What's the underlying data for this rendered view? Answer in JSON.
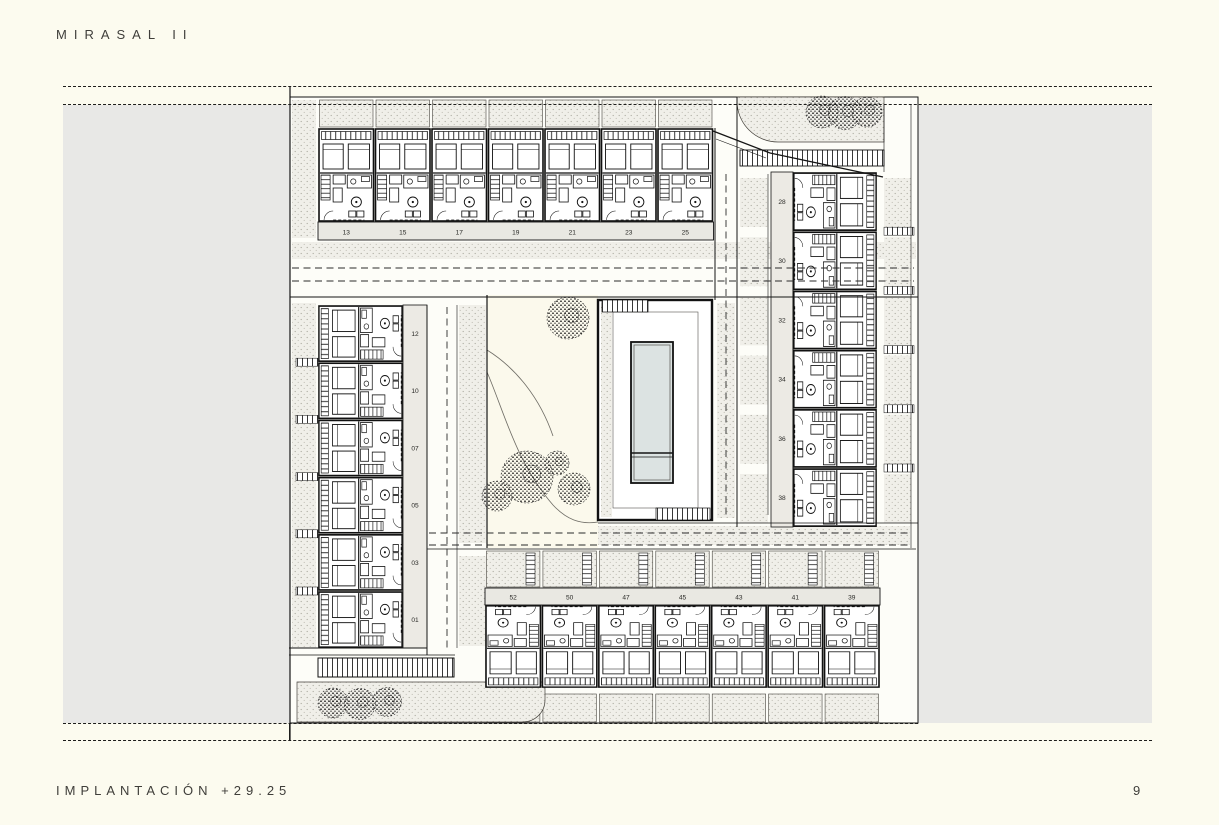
{
  "page": {
    "title": "MIRASAL II",
    "caption": "IMPLANTACIÓN +29.25",
    "page_number": "9"
  },
  "site_plan": {
    "top_row_units": [
      "13",
      "15",
      "17",
      "19",
      "21",
      "23",
      "25"
    ],
    "left_column_units": [
      "12",
      "10",
      "07",
      "05",
      "03",
      "01"
    ],
    "right_column_units": [
      "28",
      "30",
      "32",
      "34",
      "36",
      "38"
    ],
    "bottom_row_units": [
      "52",
      "50",
      "47",
      "45",
      "43",
      "41",
      "39"
    ],
    "landscape": {
      "pool": "rectangular swimming pool in central courtyard",
      "tree_groups": [
        {
          "location": "top-right-planter",
          "count": 3
        },
        {
          "location": "bottom-left-planter",
          "count": 3
        },
        {
          "location": "central-courtyard",
          "count": 5
        }
      ]
    }
  },
  "colors": {
    "paper": "#fcfbef",
    "band_gray": "#e8e8e6",
    "plan_white": "#fdfdf8",
    "stipple_ground": "#f0efe9",
    "label_strip": "#e9e8e2",
    "garden_cream": "#fbf9ec",
    "pool_water": "#dce3e2",
    "line": "#151515"
  }
}
